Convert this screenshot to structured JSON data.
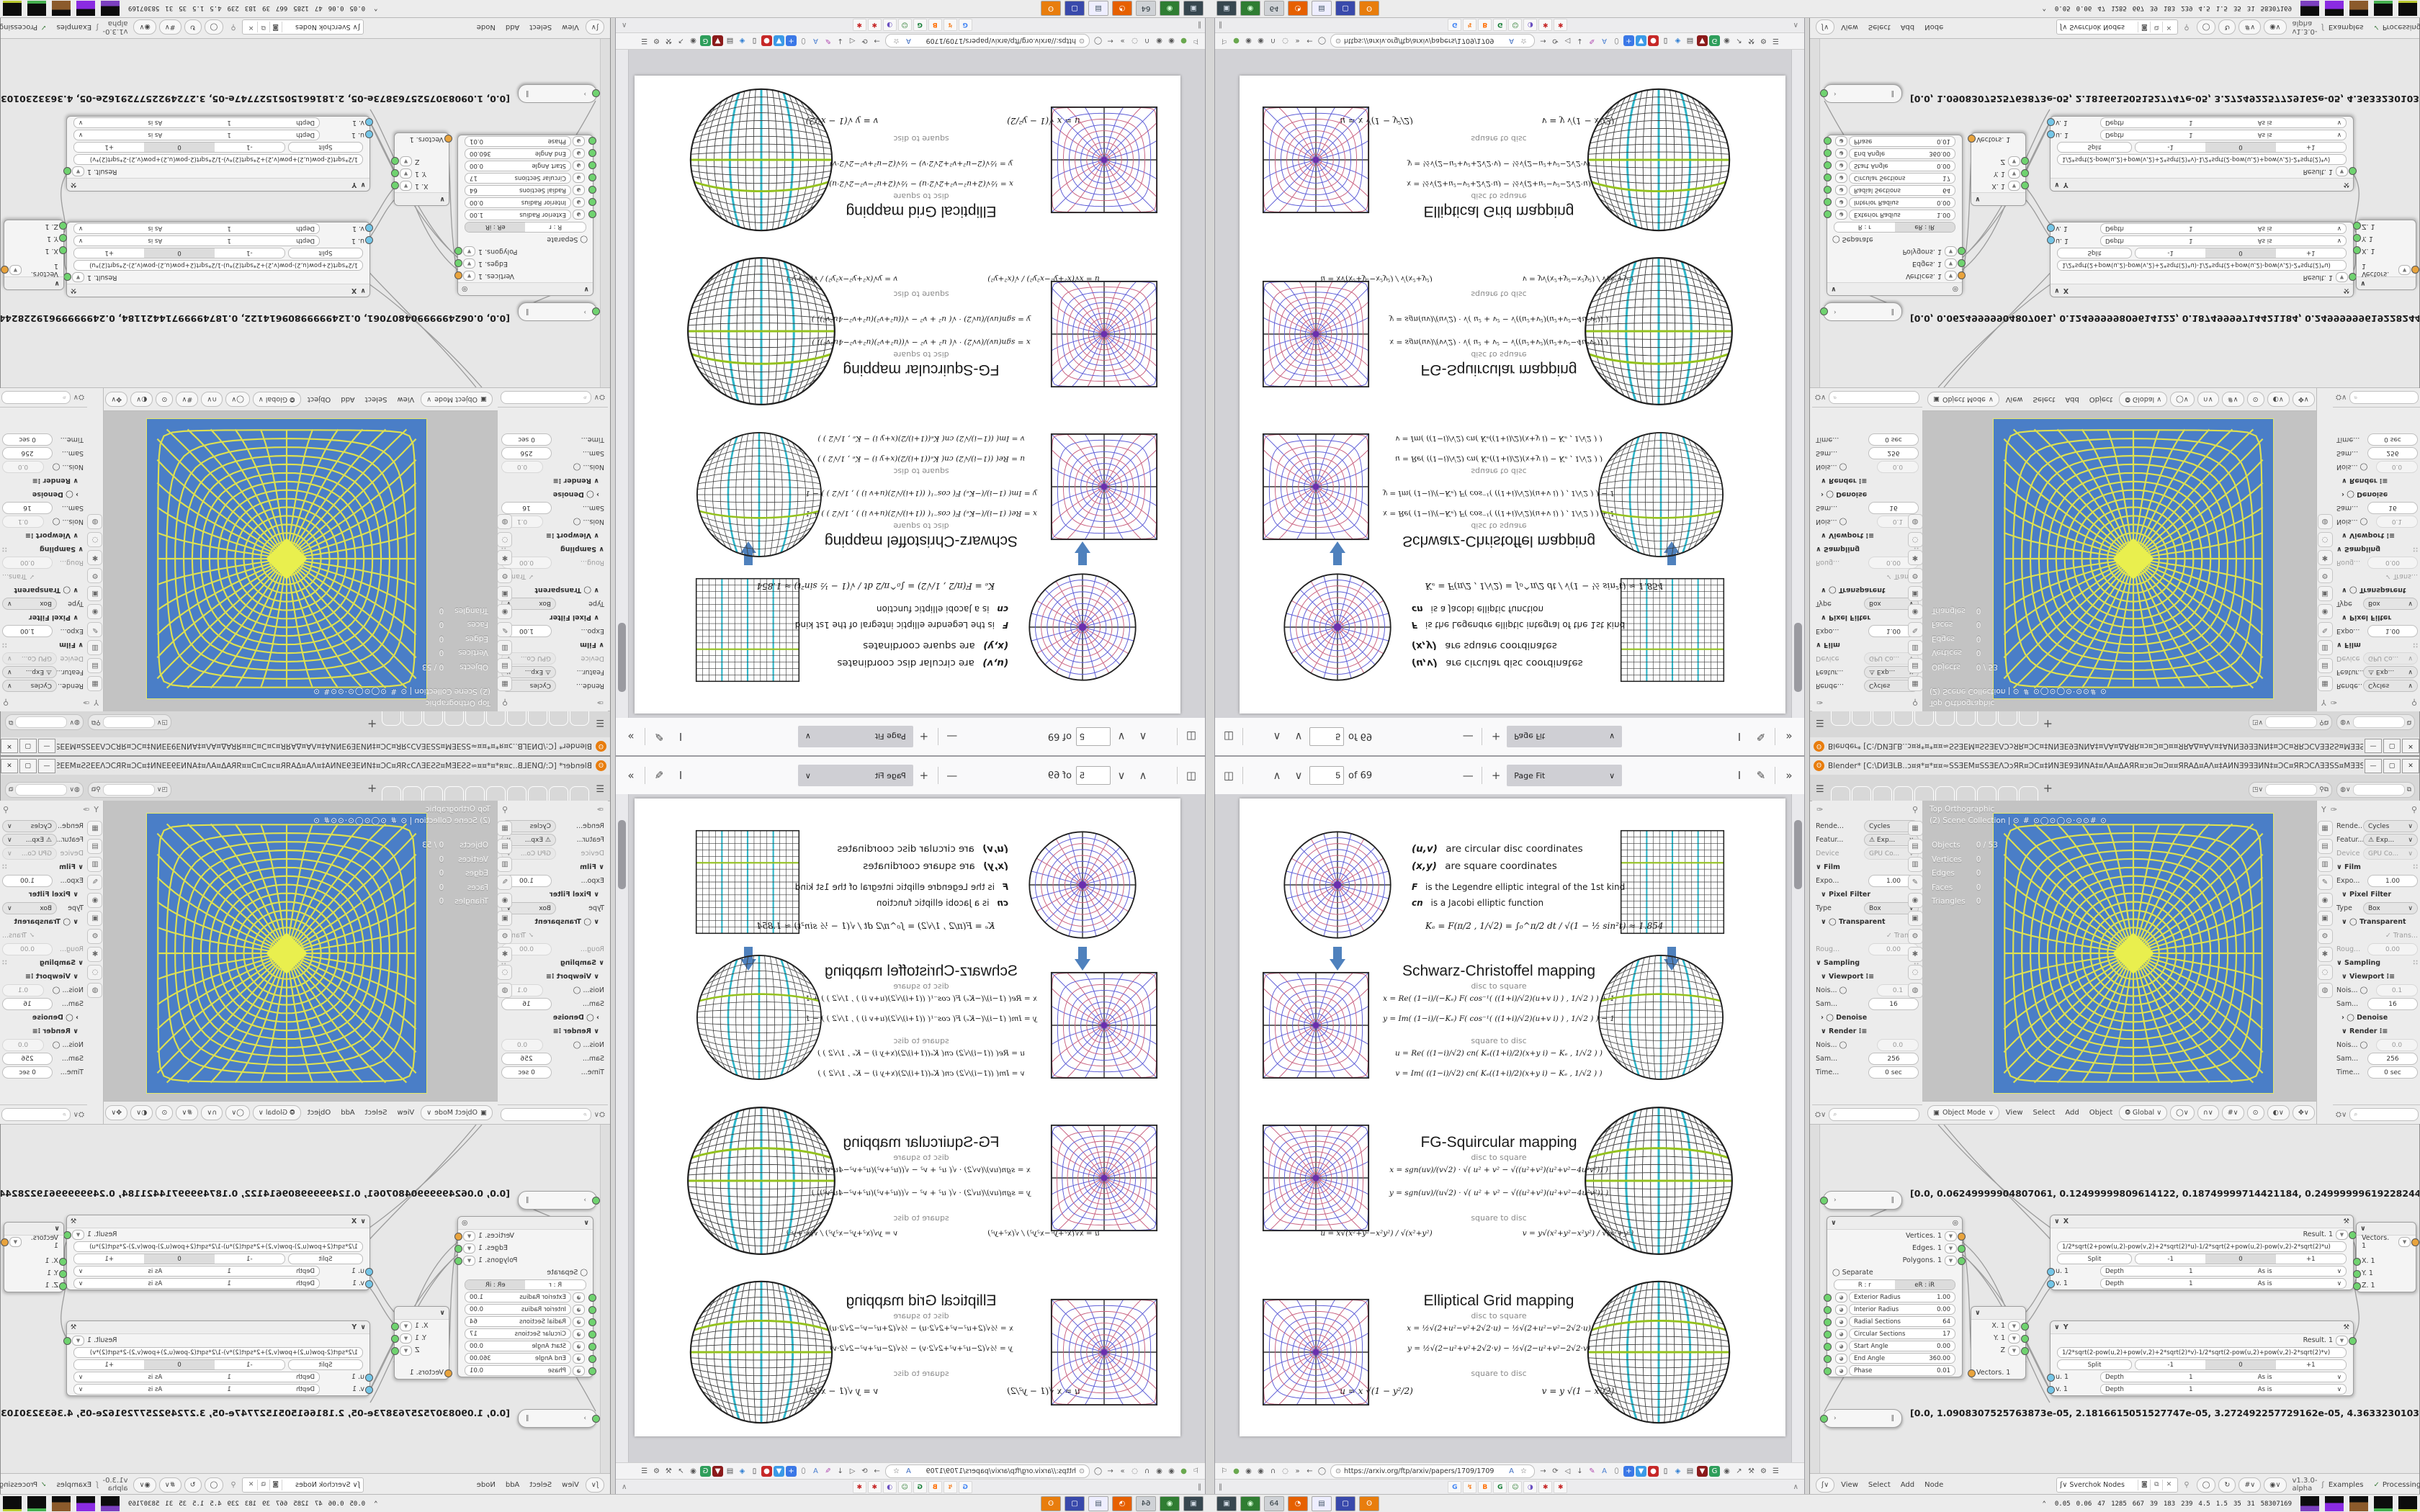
{
  "pdf_viewer": {
    "toolbar": {
      "sidebar_icon": "◫",
      "prev_icon": "∧",
      "next_icon": "∨",
      "page_value": "5",
      "page_total": "of 69",
      "zoom_out": "—",
      "zoom_in": "+",
      "zoom_label": "Page Fit",
      "zoom_caret": "∨",
      "text_tool": "I",
      "draw_tool": "✎",
      "more_tools": "»"
    },
    "page": {
      "intro": {
        "l1_pre": "(u,v)",
        "l1": "are circular disc coordinates",
        "l2_pre": "(x,y)",
        "l2": "are square coordinates",
        "l3_pre": "F",
        "l3": "is the Legendre elliptic integral of the 1st kind",
        "l4_pre": "cn",
        "l4": "is a Jacobi elliptic function",
        "k_formula": "Kₑ =  F(π∕2 , 1∕√2) = ∫₀^π∕2  dt ∕ √(1 − ½ sin²t)   ≈ 1.854"
      },
      "labels": {
        "d2s": "disc to square",
        "s2d": "square to disc"
      },
      "sections": [
        {
          "title": "Schwarz-Christoffel mapping",
          "d2s_1": "x = Re( (1−i)∕(−Kₑ) F( cos⁻¹( ((1+i)∕√2)(u+v i) ) , 1∕√2 ) ) + 1",
          "d2s_2": "y = Im( (1−i)∕(−Kₑ) F( cos⁻¹( ((1+i)∕√2)(u+v i) ) , 1∕√2 ) ) − 1",
          "s2d_1": "u = Re( ((1−i)∕√2) cn( Kₑ((1+i)∕2)(x+y i) − Kₑ , 1∕√2 ) )",
          "s2d_2": "v = Im( ((1−i)∕√2) cn( Kₑ((1+i)∕2)(x+y i) − Kₑ , 1∕√2 ) )"
        },
        {
          "title": "FG-Squircular mapping",
          "d2s_1": "x = sgn(uv)∕(v√2) · √( u² + v² − √((u²+v²)(u²+v²−4u²v²)) )",
          "d2s_2": "y = sgn(uv)∕(u√2) · √( u² + v² − √((u²+v²)(u²+v²−4u²v²)) )",
          "s2d_1": "u = x√(x²+y²−x²y²) ∕ √(x²+y²)",
          "s2d_2": "v = y√(x²+y²−x²y²) ∕ √(x²+y²)"
        },
        {
          "title": "Elliptical Grid mapping",
          "d2s_1": "x = ½√(2+u²−v²+2√2·u) − ½√(2+u²−v²−2√2·u)",
          "d2s_2": "y = ½√(2−u²+v²+2√2·v) − ½√(2−u²+v²−2√2·v)",
          "s2d_1": "u = x √(1 − y²∕2)",
          "s2d_2": "v = y √(1 − x²∕2)"
        }
      ]
    }
  },
  "browser": {
    "url": "https://arxiv.org/ftp/arxiv/papers/1709/1709",
    "lock_icon": "⊙",
    "nav_left": [
      {
        "glyph": "⚐",
        "name": "pin-icon",
        "interactable": true
      },
      {
        "glyph": "●",
        "name": "adblock-icon",
        "color": "#6aa84f",
        "interactable": true
      },
      {
        "glyph": "◉",
        "name": "globe-icon",
        "interactable": true
      },
      {
        "glyph": "◉",
        "name": "globe-icon",
        "interactable": true
      },
      {
        "glyph": "∩",
        "name": "headphones-icon",
        "interactable": true
      },
      {
        "glyph": "◌",
        "name": "circle-icon",
        "interactable": true
      },
      {
        "glyph": "»",
        "name": "overflow-chevron-icon",
        "interactable": true
      },
      {
        "glyph": "←",
        "name": "back-icon",
        "interactable": true
      },
      {
        "glyph": "◯",
        "name": "reader-icon",
        "interactable": true
      }
    ],
    "url_inner": [
      {
        "glyph": "A",
        "name": "translate-icon",
        "color": "#3d6cc0",
        "interactable": true
      },
      {
        "glyph": "☆",
        "name": "bookmark-star-icon",
        "interactable": true
      }
    ],
    "nav_right": [
      {
        "glyph": "→",
        "name": "forward-icon",
        "interactable": true
      },
      {
        "glyph": "⟳",
        "name": "reload-icon",
        "interactable": true
      },
      {
        "glyph": "◁",
        "name": "speaker-icon",
        "interactable": true
      },
      {
        "glyph": "↓",
        "name": "download-icon",
        "interactable": true
      },
      {
        "glyph": "✎",
        "name": "pencil-ext-icon",
        "color": "#b04ab0",
        "interactable": true
      },
      {
        "glyph": "A",
        "name": "translate-ext-icon",
        "color": "#4a7fd0",
        "interactable": true
      },
      {
        "glyph": "⬯",
        "name": "mask-ext-icon",
        "interactable": true
      },
      {
        "glyph": "+",
        "name": "plus-ext-icon",
        "color": "#fff",
        "bg": "#3b78e7",
        "interactable": true
      },
      {
        "glyph": "▼",
        "name": "shield-ext-icon",
        "color": "#fff",
        "bg": "#3b9ae7",
        "interactable": true
      },
      {
        "glyph": "●",
        "name": "icp-ext-icon",
        "color": "#fff",
        "bg": "#c62828",
        "interactable": true
      },
      {
        "glyph": "▯",
        "name": "trash-ext-icon",
        "color": "#333",
        "interactable": true
      },
      {
        "glyph": "◈",
        "name": "palette-ext-icon",
        "color": "#2d7dd2",
        "interactable": true
      },
      {
        "glyph": "▤",
        "name": "notes-ext-icon",
        "color": "#555",
        "interactable": true
      },
      {
        "glyph": "▼",
        "name": "ublock-icon",
        "color": "#fff",
        "bg": "#8b1a1a",
        "interactable": true
      },
      {
        "glyph": "G",
        "name": "google-ext-icon",
        "color": "#fff",
        "bg": "#2e9e5b",
        "interactable": true
      },
      {
        "glyph": "◉",
        "name": "globe2-icon",
        "interactable": true
      },
      {
        "glyph": "↗",
        "name": "share-icon",
        "interactable": true
      },
      {
        "glyph": "⚒",
        "name": "wrench-icon",
        "interactable": true
      },
      {
        "glyph": "⚙",
        "name": "gear-icon",
        "interactable": true
      },
      {
        "glyph": "☰",
        "name": "menu-icon",
        "interactable": true
      }
    ],
    "tab_left": "‖",
    "pinned_tabs": [
      {
        "glyph": "G",
        "name": "pinned-tab-google",
        "color": "#4285f4",
        "interactable": true
      },
      {
        "glyph": "↯",
        "name": "pinned-tab-stackoverflow",
        "color": "#f48024",
        "interactable": true
      },
      {
        "glyph": "B",
        "name": "pinned-tab-blogger",
        "color": "#ff6d00",
        "interactable": true
      },
      {
        "glyph": "G",
        "name": "pinned-tab-google2",
        "color": "#188038",
        "interactable": true
      },
      {
        "glyph": "☺",
        "name": "pinned-tab-smiley",
        "color": "#2e7d32",
        "interactable": true
      },
      {
        "glyph": "◑",
        "name": "pinned-tab-chat",
        "color": "#6a4fc1",
        "interactable": true
      },
      {
        "glyph": "✱",
        "name": "pinned-tab-gear1",
        "color": "#c62828",
        "interactable": true
      },
      {
        "glyph": "✱",
        "name": "pinned-tab-gear2",
        "color": "#c62828",
        "interactable": true
      }
    ],
    "tab_overflow": "∧"
  },
  "blender": {
    "title": "Blender* [C:\\DИƎLB..ɔ¤я*¤*¤¤≈SSƎEM¤SSƎEΛƆɔЯR¤ƆC¤‡ИNƎE9ƎИNA‡¤ΛA¤ΔAЯR¤ɔ¤Ɔ¤Ɔ¤¤ЯRAΔ¤AΛ¤‡AИNƎ9ƎƎИN‡¤ƆC¤ЯRƆCΛƎƎSS¤MƎƎSSƎ≈¤¤*¤*≈¤ɔ..",
    "win_buttons": {
      "min": "—",
      "max": "▢",
      "close": "✕"
    },
    "topbar": {
      "menu_icon": "☰",
      "workspace_tabs": [
        {
          "glyph": "",
          "name": "workspace-tab",
          "interactable": true
        },
        {
          "glyph": "",
          "name": "workspace-tab",
          "interactable": true
        },
        {
          "glyph": "",
          "name": "workspace-tab",
          "interactable": true
        },
        {
          "glyph": "",
          "name": "workspace-tab",
          "interactable": true
        },
        {
          "glyph": "",
          "name": "workspace-tab",
          "interactable": true
        },
        {
          "glyph": "",
          "name": "workspace-tab",
          "interactable": true
        },
        {
          "glyph": "",
          "name": "workspace-tab",
          "interactable": true
        },
        {
          "glyph": "",
          "name": "workspace-tab",
          "interactable": true
        },
        {
          "glyph": "",
          "name": "workspace-tab",
          "interactable": true
        },
        {
          "glyph": "",
          "name": "workspace-tab",
          "interactable": true
        }
      ],
      "add_tab": "+",
      "scene_icon": "◳",
      "pin_icon": "⚲",
      "copy_icon": "⧉",
      "viewlayer_icon": "◍"
    },
    "props": {
      "nav_icon": "✑",
      "filter_icon": "Y",
      "pin_icon": "⚲",
      "rows": [
        {
          "label": "Rende...",
          "value": "Cycles"
        },
        {
          "label": "Featur...",
          "value": "⚠ Exp..."
        },
        {
          "label": "Device",
          "value": "GPU Co..."
        },
        {
          "label": "∨ Film",
          "value": "∷"
        },
        {
          "label": "Expo...",
          "value": "1.00"
        },
        {
          "label": "∨ Pixel Filter",
          "value": ""
        },
        {
          "label": "Type",
          "value": "Box"
        },
        {
          "label": "∨ ◯ Transparent",
          "value": ""
        },
        {
          "label": "",
          "value": "✓ Trans..."
        },
        {
          "label": "Roug...",
          "value": "0.00"
        },
        {
          "label": "∨ Sampling",
          "value": "∷"
        },
        {
          "label": "∨ Viewport ⁝≡",
          "value": ""
        },
        {
          "label": "Nois... ◯",
          "value": "0.1"
        },
        {
          "label": "Sam...",
          "value": "16"
        },
        {
          "label": "› ◯ Denoise",
          "value": ""
        },
        {
          "label": "∨ Render ⁝≡",
          "value": ""
        },
        {
          "label": "Nois... ◯",
          "value": "0.0"
        },
        {
          "label": "Sam...",
          "value": "256"
        },
        {
          "label": "Time...",
          "value": "0 sec"
        }
      ],
      "tab_icons": [
        {
          "glyph": "▦",
          "name": "tab-render",
          "interactable": true
        },
        {
          "glyph": "▤",
          "name": "tab-output",
          "interactable": true
        },
        {
          "glyph": "▥",
          "name": "tab-view-layer",
          "interactable": true
        },
        {
          "glyph": "✎",
          "name": "tab-scene",
          "interactable": true
        },
        {
          "glyph": "◉",
          "name": "tab-world",
          "interactable": true
        },
        {
          "glyph": "▣",
          "name": "tab-object",
          "interactable": true
        },
        {
          "glyph": "⚙",
          "name": "tab-modifiers",
          "interactable": true
        },
        {
          "glyph": "✱",
          "name": "tab-particles",
          "interactable": true
        },
        {
          "glyph": "◌",
          "name": "tab-physics",
          "interactable": true
        },
        {
          "glyph": "◍",
          "name": "tab-data",
          "interactable": true
        }
      ]
    },
    "viewport": {
      "view_label": "Top Orthographic",
      "collection_label": "(2) Scene Collection |",
      "gizmo_glyphs": "⊙ # ⊙◯⊙◯⊙·⊙⊙# ⊙",
      "stats": [
        {
          "k": "Objects",
          "v": "0 / 53"
        },
        {
          "k": "Vertices",
          "v": "0"
        },
        {
          "k": "Edges",
          "v": "0"
        },
        {
          "k": "Faces",
          "v": "0"
        },
        {
          "k": "Triangles",
          "v": "0"
        }
      ],
      "mode": "Object Mode",
      "mode_caret": "∨",
      "menus": [
        "View",
        "Select",
        "Add",
        "Object"
      ],
      "orient": "⭗ Global ∨",
      "header_icons": [
        {
          "glyph": "◯∨",
          "name": "pivot-dropdown",
          "interactable": true
        },
        {
          "glyph": "∩∨",
          "name": "snap-magnet-dropdown",
          "interactable": true
        },
        {
          "glyph": "#∨",
          "name": "snap-target-dropdown",
          "interactable": true
        },
        {
          "glyph": "⊙",
          "name": "proportional-edit-icon",
          "interactable": true
        },
        {
          "glyph": "◐∨",
          "name": "shading-dropdown",
          "interactable": true
        },
        {
          "glyph": "✥∨",
          "name": "gizmo-dropdown",
          "interactable": true
        },
        {
          "glyph": "◉∨",
          "name": "overlay-dropdown",
          "interactable": true
        },
        {
          "glyph": "◯",
          "name": "xray-toggle",
          "interactable": true
        }
      ]
    },
    "node_editor": {
      "steth1": "[0.0, 0.06249999904807061, 0.12499999809614122, 0.18749999714421184, 0.24999999619228244, 0.31249999524035305, 0.374",
      "steth2": "[0.0, 1.0908307525763873e-05, 2.1816615051527747e-05, 3.272492257729162e-05, 4.363323010305549e-05, 5.454153762881936e-05",
      "pill_play": "›",
      "pill_pause": "‖",
      "ring_node": {
        "gear_icon": "◎",
        "out_vertices": "Vertices. 1",
        "out_edges": "Edges. 1",
        "out_polygons": "Polygons. 1",
        "separate": "◯ Separate",
        "mode_a": "R : r",
        "mode_b": "eR : iR",
        "sliders": [
          {
            "label": "Exterior Radius",
            "value": "1.00"
          },
          {
            "label": "Interior Radius",
            "value": "0.00"
          },
          {
            "label": "Radial Sections",
            "value": "64"
          },
          {
            "label": "Circular Sections",
            "value": "17"
          },
          {
            "label": "Start Angle",
            "value": "0.00"
          },
          {
            "label": "End Angle",
            "value": "360.00"
          },
          {
            "label": "Phase",
            "value": "0.01"
          }
        ]
      },
      "vec_out_node": {
        "rows": [
          "X. 1",
          "Y. 1",
          "Z"
        ],
        "input": "Vectors. 1"
      },
      "formula_x": {
        "title": "X",
        "wrench": "⚒",
        "result": "Result. 1",
        "formula": "1/2*sqrt(2+pow(u,2)-pow(v,2)+2*sqrt(2)*u)-1/2*sqrt(2+pow(u,2)-pow(v,2)-2*sqrt(2)*u)",
        "split": "Split",
        "seg": [
          "-1",
          "0",
          "+1"
        ],
        "depth_label": "Depth",
        "depth_value": "1",
        "depth_mode": "As is",
        "in_u": "u. 1",
        "in_v": "v. 1"
      },
      "formula_y": {
        "title": "Y",
        "wrench": "⚒",
        "result": "Result. 1",
        "formula": "1/2*sqrt(2-pow(u,2)+pow(v,2)+2*sqrt(2)*v)-1/2*sqrt(2-pow(u,2)+pow(v,2)-2*sqrt(2)*v)",
        "split": "Split",
        "seg": [
          "-1",
          "0",
          "+1"
        ],
        "depth_label": "Depth",
        "depth_value": "1",
        "depth_mode": "As is",
        "in_u": "u. 1",
        "in_v": "v. 1"
      },
      "vec_in_node": {
        "output": "Vectors. 1",
        "rows": [
          "X. 1",
          "Y. 1",
          "Z. 1"
        ]
      },
      "header": {
        "tree_icon": "ʃ∨",
        "menus": [
          "View",
          "Select",
          "Add",
          "Node"
        ],
        "search_icon": "ʃ∨",
        "search_value": "Sverchok Nodes",
        "search_btns": [
          "◙",
          "⧉",
          "✕"
        ],
        "pin_icon": "⚲",
        "right_icons": [
          "◯",
          "↻",
          "#∨",
          "◉∨"
        ],
        "version": "v1.3.0-alpha",
        "logo": "ʃ",
        "examples": "Examples",
        "processing_check": "✓",
        "processing": "Processing"
      }
    }
  },
  "taskbar": {
    "apps": [
      {
        "glyph": "▣",
        "name": "app-screenshot",
        "color": "#cfd8e3",
        "bg": "#37474f",
        "interactable": true
      },
      {
        "glyph": "◉",
        "name": "app-camera",
        "color": "#d7ffd7",
        "bg": "#2f7d32",
        "interactable": true
      },
      {
        "glyph": "64",
        "name": "app-save64",
        "color": "#263238",
        "bg": "#cfd2d6",
        "interactable": true
      },
      {
        "glyph": "◔",
        "name": "app-firefox",
        "color": "#fff",
        "bg": "#e66000",
        "interactable": true
      },
      {
        "glyph": "▤",
        "name": "app-notes",
        "color": "#456",
        "bg": "#eef",
        "interactable": true
      },
      {
        "glyph": "▢",
        "name": "app-window",
        "color": "#fff",
        "bg": "#3949ab",
        "interactable": true
      },
      {
        "glyph": "ʘ",
        "name": "app-blender",
        "color": "#fff",
        "bg": "#e87d0d",
        "interactable": true
      }
    ],
    "stats_icon": "⌃",
    "stats": [
      "0.05",
      "0.06",
      "47",
      "1285",
      "667",
      "39",
      "183",
      "239",
      "4.5",
      "1.5",
      "35",
      "31",
      "58307169"
    ]
  },
  "figures": {
    "polar_main": {
      "type": "polar",
      "rings": 9,
      "spokes": 24,
      "c1": "#c8607f",
      "c2": "#5c5cd6"
    },
    "grid_main": {
      "type": "grid",
      "n": 16,
      "cyan": [
        -0.5,
        0,
        0.5
      ],
      "green": [
        -0.38,
        0.31
      ]
    },
    "sc_square": {
      "type": "d2sq",
      "rings": 9,
      "spokes": 24,
      "c1": "#c8607f",
      "c2": "#5c5cd6"
    },
    "sc_disc": {
      "type": "sq2d",
      "n": 16,
      "cyan": [
        -0.5,
        0,
        0.5
      ],
      "green": [
        -0.38,
        0.31
      ]
    },
    "fg_square": {
      "type": "d2sq",
      "rings": 10,
      "spokes": 28,
      "c1": "#c8607f",
      "c2": "#5c5cd6"
    },
    "fg_disc": {
      "type": "sq2d",
      "n": 18,
      "cyan": [
        -0.45,
        0,
        0.45
      ],
      "green": [
        -0.42,
        0,
        0.38
      ]
    },
    "eg_square": {
      "type": "d2sq",
      "rings": 9,
      "spokes": 24,
      "c1": "#c8607f",
      "c2": "#5c5cd6"
    },
    "eg_disc": {
      "type": "sq2d",
      "n": 18,
      "cyan": [
        -0.45,
        0,
        0.45
      ],
      "green": [
        -0.42,
        0,
        0.38
      ]
    },
    "viewport": {
      "type": "d2sq",
      "rings": 15,
      "spokes": 44,
      "mono": "#dde052",
      "bg": "#4a7ec7",
      "blob": true
    }
  },
  "colors": {
    "accent_blue_square": "#4a7ec7",
    "wire_yellow": "#dde052",
    "pdf_cyan": "#2fb6c9",
    "pdf_green": "#94c11f",
    "arrow_blue": "#4f81bd",
    "socket_green": "#6fd36f",
    "socket_orange": "#e8a33d",
    "socket_blue": "#74c6e8"
  }
}
